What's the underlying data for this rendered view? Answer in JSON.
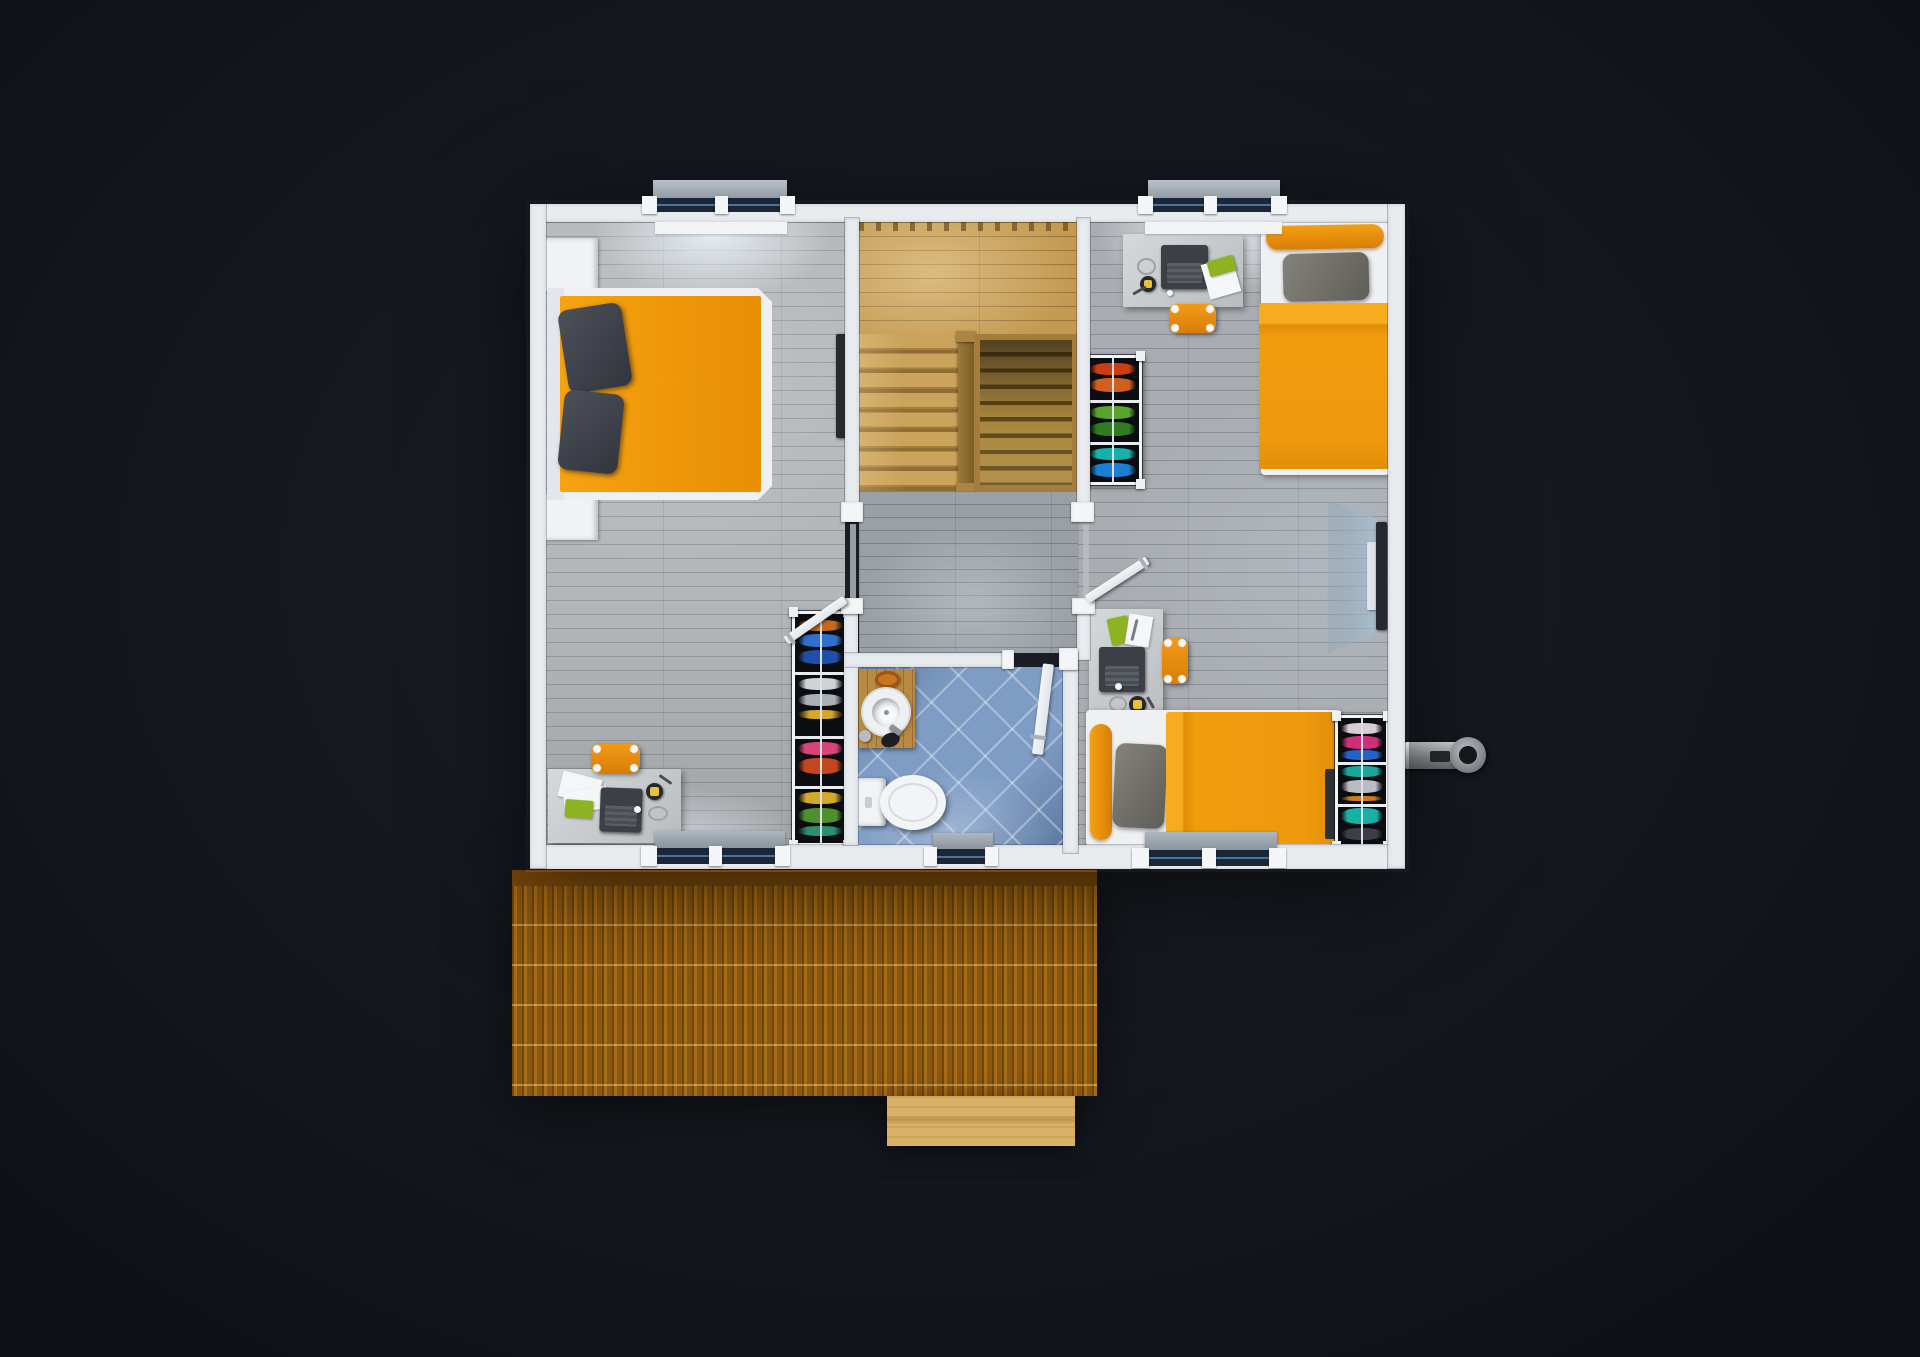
{
  "scene": {
    "title": "3D rendered upper-floor plan, top-down view",
    "background": "#14171d",
    "palette": {
      "background": "#14171d",
      "wall": "#e9ecef",
      "cap": "#f3f5f7",
      "floor_master": "#b4b7ba",
      "floor_kids": "#a9adb1",
      "floor_hall": "#9aa0a6",
      "stair": "#c49a52",
      "stair_dark": "#8f6c33",
      "tile": "#7e9cc4",
      "orange": "#f09c0c",
      "green": "#8db320",
      "laptop": "#3c3f45",
      "ward": "#0b0d10",
      "tv": "#26292e",
      "deck": "#91590f",
      "deck_dark": "#7b4a0c",
      "step": "#d9b267",
      "glass": "#1b2736",
      "glass_line": "#4a749f"
    },
    "rooms": [
      {
        "id": "master-bedroom",
        "furniture": [
          "double-bed-orange",
          "two-dark-pillows",
          "wall-tv",
          "desk-with-laptop",
          "orange-desk-chair",
          "open-wardrobe",
          "nightstand-top",
          "nightstand-bottom"
        ]
      },
      {
        "id": "stairwell",
        "furniture": [
          "wood-landing",
          "stair-flight-left",
          "wood-railing",
          "stair-flight-right"
        ]
      },
      {
        "id": "hallway",
        "furniture": []
      },
      {
        "id": "bathroom",
        "furniture": [
          "toilet",
          "vessel-sink",
          "wooden-washstand",
          "soap-dish",
          "lotion-bottle",
          "scrub-brush"
        ]
      },
      {
        "id": "kids-bedroom",
        "furniture": [
          "desk-with-laptop-top",
          "orange-chair-top",
          "single-bed-top-orange",
          "open-wardrobe-left",
          "tv-on-glass-stand",
          "desk-with-laptop-bottom",
          "orange-chair-bottom",
          "single-bed-bottom-orange",
          "open-wardrobe-right"
        ]
      }
    ],
    "exterior": {
      "features": [
        "slatted-deck-roof",
        "entry-step",
        "chimney-pipe"
      ]
    },
    "openings": {
      "windows": 5,
      "interior_doors": 3
    },
    "counts": {
      "beds": 3,
      "desks": 3,
      "wardrobes": 3,
      "tvs": 2,
      "chairs": 3
    }
  }
}
